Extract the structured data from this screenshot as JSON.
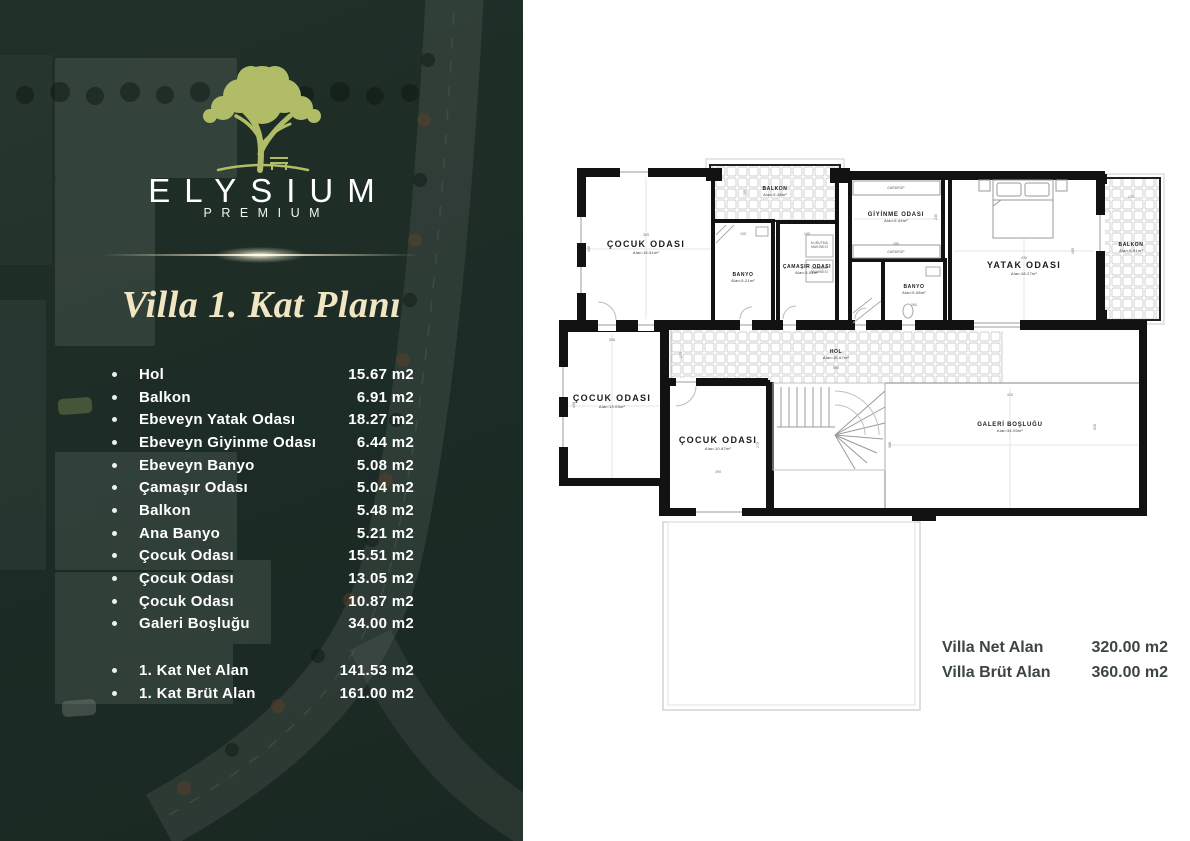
{
  "brand": {
    "name": "ELYSIUM",
    "tagline": "PREMIUM"
  },
  "page_title": "Villa 1. Kat Planı",
  "room_list": {
    "items": [
      {
        "label": "Hol",
        "area": "15.67 m2"
      },
      {
        "label": "Balkon",
        "area": "6.91 m2"
      },
      {
        "label": "Ebeveyn Yatak Odası",
        "area": "18.27 m2"
      },
      {
        "label": "Ebeveyn Giyinme Odası",
        "area": "6.44 m2"
      },
      {
        "label": "Ebeveyn Banyo",
        "area": "5.08 m2"
      },
      {
        "label": "Çamaşır Odası",
        "area": "5.04 m2"
      },
      {
        "label": "Balkon",
        "area": "5.48 m2"
      },
      {
        "label": "Ana Banyo",
        "area": "5.21 m2"
      },
      {
        "label": "Çocuk Odası",
        "area": "15.51 m2"
      },
      {
        "label": "Çocuk Odası",
        "area": "13.05 m2"
      },
      {
        "label": "Çocuk Odası",
        "area": "10.87 m2"
      },
      {
        "label": "Galeri Boşluğu",
        "area": "34.00 m2"
      }
    ],
    "totals": [
      {
        "label": "1. Kat Net Alan",
        "area": "141.53 m2"
      },
      {
        "label": "1. Kat Brüt Alan",
        "area": "161.00 m2"
      }
    ]
  },
  "plan": {
    "rooms": [
      {
        "name": "ÇOCUK ODASI",
        "area": "Alan:15.51m²"
      },
      {
        "name": "BALKON",
        "area": "Alan:5.48m²"
      },
      {
        "name": "BANYO",
        "area": "Alan:5.21m²"
      },
      {
        "name": "ÇAMAŞIR ODASI",
        "area": "Alan:5.04m²"
      },
      {
        "name": "GİYİNME ODASI",
        "area": "Alan:6.44m²"
      },
      {
        "name": "BANYO",
        "area": "Alan:5.08m²"
      },
      {
        "name": "YATAK ODASI",
        "area": "Alan:18.27m²"
      },
      {
        "name": "BALKON",
        "area": "Alan:6.91m²"
      },
      {
        "name": "HOL",
        "area": "Alan:15.67m²"
      },
      {
        "name": "ÇOCUK ODASI",
        "area": "Alan:13.05m²"
      },
      {
        "name": "ÇOCUK ODASI",
        "area": "Alan:10.87m²"
      },
      {
        "name": "GALERİ BOŞLUĞU",
        "area": "Alan:34.00m²"
      }
    ],
    "wardrobe_label": "GARDROP",
    "appliances": [
      {
        "line1": "KURUTMA",
        "line2": "MAKİNESİ"
      },
      {
        "line1": "ÇAMAŞIR",
        "line2": "MAKİNESİ"
      }
    ],
    "dimensions": [
      "305",
      "435",
      "155",
      "105",
      "105",
      "280",
      "230",
      "430",
      "405",
      "170",
      "260",
      "175",
      "980",
      "308",
      "436",
      "290",
      "275",
      "420",
      "525",
      "308"
    ],
    "totals": [
      {
        "label": "Villa Net Alan",
        "value": "320.00 m2"
      },
      {
        "label": "Villa Brüt Alan",
        "value": "360.00 m2"
      }
    ]
  },
  "colors": {
    "panel_green": "#20302a",
    "logo_olive": "#b0bd66",
    "title_cream": "#f1e6c3",
    "list_text": "#ffffff",
    "plan_wall": "#121212",
    "totals_text": "#3d4546"
  }
}
